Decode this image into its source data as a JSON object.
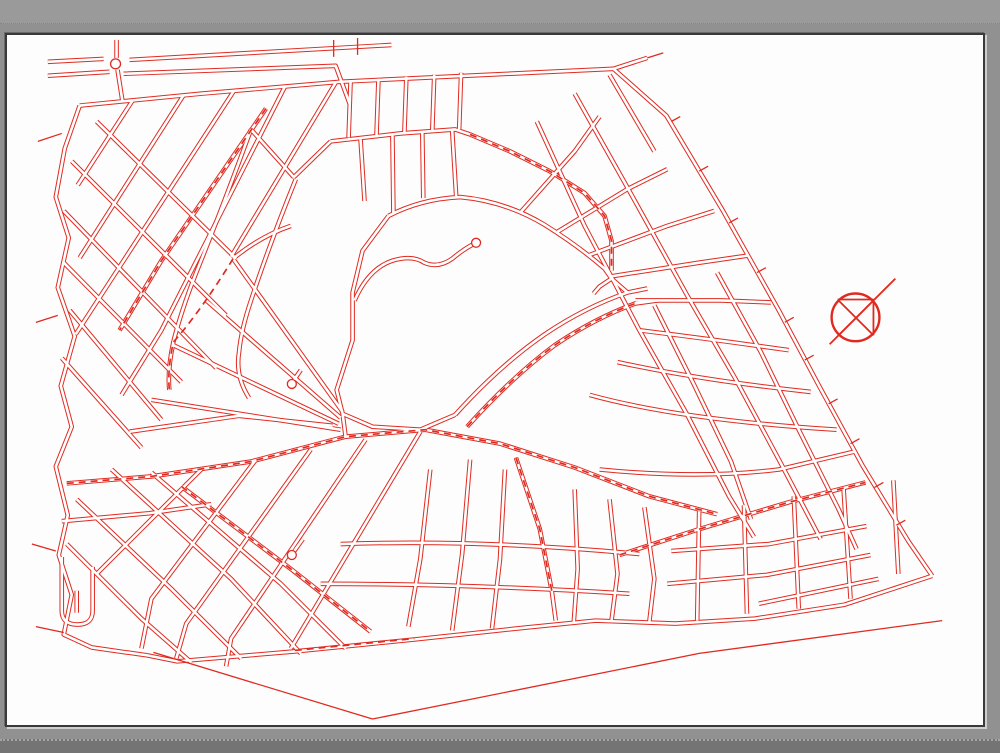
{
  "viewer": {
    "description": "cad-map-preview",
    "colors": {
      "bg_gray": "#919191",
      "bg_gray_light": "#9a9a9a",
      "bg_gray_dark": "#747474",
      "sheet_white": "#fdfdfd",
      "line_red": "#e02a20"
    }
  },
  "drawing": {
    "stroke_color": "#e02a20",
    "core_color": "#ffffff",
    "casing_width": 4.6,
    "core_width": 2.6,
    "single_width": 1.3,
    "dash_width": 1.7,
    "dash_pattern": "7 5",
    "roads": [
      "M78,104 L200,92 L340,80 L614,67",
      "M614,67 L667,114 L724,210 L780,310 L821,387 L864,466 L910,542 L934,577",
      "M934,577 L846,606 L756,620 L676,625 L596,622 L526,629 L414,641 L294,653 L176,663 L146,657",
      "M78,104 L63,147 L54,196 L67,237 L56,287 L73,336 L59,386 L70,427 L54,467 L66,516 L57,556 L70,596 L62,636 L90,649 L146,657",
      "M614,67 L648,56",
      "M46,60 L102,57",
      "M46,74 L108,70",
      "M128,58 L391,43",
      "M122,72 L335,64 L349,102",
      "M115,38 L115,56",
      "M116,68 L121,100",
      "M131,99 L76,184",
      "M182,94 L78,257",
      "M233,89 L74,334",
      "M284,85 L160,330 L120,395",
      "M265,107 L160,260 L118,330",
      "M335,81 L230,256",
      "M95,120 L235,258",
      "M70,160 L225,315",
      "M62,210 L215,368",
      "M62,262 L180,382",
      "M68,310 L160,420",
      "M60,358 L140,448",
      "M342,412 L232,258",
      "M340,418 L205,300",
      "M338,424 L172,345",
      "M340,430 L150,400",
      "M250,128 Q222,205 195,272 Q180,310 172,342 Q166,370 168,390",
      "M295,178 Q268,245 250,300 Q240,330 238,352 Q234,376 248,398",
      "M232,258 Q260,235 290,225",
      "M250,128 L293,176",
      "M293,176 L330,140",
      "M330,140 L400,132 L455,128 L470,133",
      "M350,79 L348,136",
      "M378,77 L376,134",
      "M406,75 L404,132",
      "M434,73 L432,130",
      "M461,71 L459,128",
      "M360,138 L364,200",
      "M392,134 L393,212",
      "M422,131 L423,197",
      "M452,129 L456,195",
      "M470,133 L510,150 L550,170 L585,192 L605,215 L612,240 L612,270",
      "M575,92 L630,190 L688,295 L736,378 L780,460 L822,540",
      "M537,120 L585,225 L640,330 L688,415 L730,497 L755,538",
      "M610,73 L655,150",
      "M655,305 L695,385 L732,462 L752,520",
      "M718,272 L762,352 L800,430 L840,510 L858,550",
      "M520,212 L575,150 L600,115",
      "M556,232 L628,188 L668,168",
      "M588,255 L668,225 L715,210",
      "M610,276 L700,262 L748,255",
      "M636,300 L722,300 L772,302",
      "M640,330 Q720,340 790,350",
      "M618,362 Q700,380 812,392",
      "M590,395 Q680,420 838,430",
      "M600,470 Q700,480 780,470 L856,452",
      "M620,556 L700,530 L790,503 L867,483",
      "M388,215 L362,250 L352,292 L352,340 L336,390 L342,414",
      "M342,414 L372,427 L420,430 L455,415",
      "M455,415 Q500,365 545,334 Q585,307 628,292 L648,288",
      "M467,427 Q512,377 555,345 Q595,318 636,303 L658,300",
      "M388,215 Q420,198 460,196 Q505,200 545,224 Q580,246 605,268 L612,278",
      "M612,278 L600,286 L594,293",
      "M612,278 L628,292",
      "M354,300 Q368,268 392,260 Q412,254 424,262 Q438,268 452,258 Q464,248 474,243",
      "M65,484 L150,477 L250,462 L345,437 L425,430 L500,444 L575,468 L650,497 L718,515",
      "M128,432 L238,416 L332,426",
      "M60,522 L148,514 L210,505",
      "M342,414 L345,437",
      "M200,470 L95,575",
      "M255,460 L150,600 L140,650",
      "M310,450 L185,625 L175,660",
      "M365,440 L230,640 L225,668",
      "M420,432 L290,650",
      "M75,500 L170,590 L240,660",
      "M110,470 L230,580 L300,655",
      "M150,473 L280,585 L345,650",
      "M180,487 L290,570 L370,633",
      "M65,545 L140,620 L190,664",
      "M60,558 L60,612 Q60,626 76,626 Q91,626 91,612 L91,568",
      "M75,592 L75,614",
      "M430,470 L420,560 L408,628",
      "M470,460 L462,555 L452,632",
      "M516,458 L540,530 L552,592 L556,622",
      "M505,470 L500,560 L492,630",
      "M575,490 L578,570 L574,625",
      "M610,500 L618,575 L612,622",
      "M645,508 L655,580 L650,623",
      "M340,545 Q480,540 640,555",
      "M320,585 Q470,585 630,595",
      "M672,552 L770,545 L868,527",
      "M668,585 L768,576 L872,556",
      "M760,605 L880,580",
      "M700,512 L698,622",
      "M745,506 L748,615",
      "M795,497 L800,610",
      "M845,489 L852,600",
      "M895,481 L900,575",
      "M302,540 L292,554",
      "M300,370 L291,383"
    ],
    "singles": [
      "M152,654 L372,721",
      "M372,721 L700,655 L944,622",
      "M36,140 L60,132",
      "M34,322 L56,315",
      "M30,545 L54,552",
      "M34,628 L62,634",
      "M333,38 L333,55",
      "M357,36 L357,53",
      "M648,56 L664,51",
      "M672,120 L681,115",
      "M700,170 L709,165",
      "M730,222 L739,217",
      "M758,272 L767,267",
      "M786,322 L795,317",
      "M806,360 L815,355",
      "M830,404 L839,399",
      "M852,444 L861,439",
      "M876,488 L885,483",
      "M898,526 L907,521"
    ],
    "dashed": [
      "M265,107 L160,260 L118,330",
      "M470,133 L510,150 L550,170 L585,192 L605,215 L612,240 L612,270",
      "M65,484 L150,477 L250,462 L345,437 L425,430 L500,444 L575,468 L650,497 L718,515",
      "M620,556 L700,530 L790,503 L867,483",
      "M180,487 L290,570 L370,633",
      "M467,427 Q512,377 555,345 Q595,318 636,303",
      "M232,258 Q200,310 172,342 Q166,370 168,390",
      "M294,652 L414,640",
      "M516,458 L540,530 L552,592"
    ],
    "circles": [
      {
        "name": "roundabout",
        "cx": 114,
        "cy": 62,
        "r": 5
      },
      {
        "name": "culdesac-bulb",
        "cx": 476,
        "cy": 242,
        "r": 4.5
      },
      {
        "name": "culdesac-bulb",
        "cx": 291,
        "cy": 384,
        "r": 4.5
      },
      {
        "name": "culdesac-bulb",
        "cx": 291,
        "cy": 556,
        "r": 4.5
      }
    ],
    "north_symbol": {
      "cx": 857,
      "cy": 317,
      "r": 24,
      "circle_width": 2.4,
      "line_width": 1.8,
      "lines": [
        [
          831,
          344,
          897,
          278
        ],
        [
          840,
          300,
          875,
          335
        ],
        [
          875,
          300,
          840,
          335
        ],
        [
          839,
          299,
          875,
          299
        ],
        [
          875,
          299,
          875,
          335
        ]
      ]
    }
  }
}
